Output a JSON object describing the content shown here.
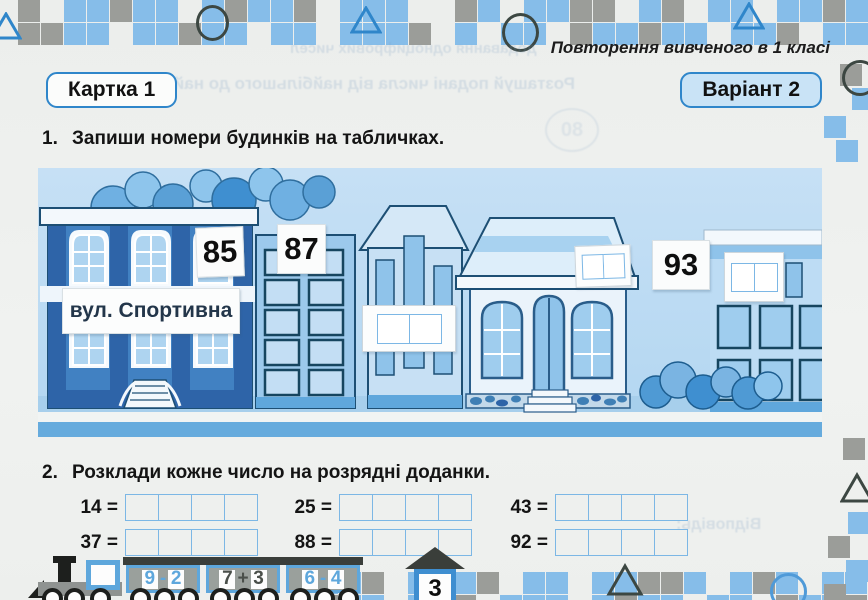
{
  "page": {
    "header_note": "Повторення вивченого в 1 класі",
    "card_badge": "Картка 1",
    "variant_badge": "Варіант 2",
    "page_number": "3"
  },
  "task1": {
    "number": "1.",
    "text": "Запиши номери будинків на табличках."
  },
  "illustration": {
    "street_sign": "вул. Спортивна",
    "plates": {
      "p85": "85",
      "p87": "87",
      "p93": "93"
    }
  },
  "task2": {
    "number": "2.",
    "text": "Розклади кожне число на розрядні доданки.",
    "items": [
      "14 =",
      "25 =",
      "43 =",
      "37 =",
      "88 =",
      "92 ="
    ]
  },
  "train": {
    "cars": [
      [
        "9",
        "-",
        "2"
      ],
      [
        "7",
        "+",
        "3"
      ],
      [
        "6",
        "-",
        "4"
      ]
    ]
  },
  "bleedthrough": {
    "line1": "Розташуй подані числа від найбільшого до найменшого.",
    "line2": "додавання одноцифрових чисел",
    "line3": "Відповідь:",
    "num1": "80"
  },
  "colors": {
    "accent_blue": "#2f86ca",
    "mosaic_blue": "#86bde9",
    "mosaic_gray": "#9b9d99",
    "panel_sky": "#bcdaf2",
    "road_blue": "#66abdd",
    "train_blue": "#5ea7dc",
    "plate_text": "#111111"
  }
}
